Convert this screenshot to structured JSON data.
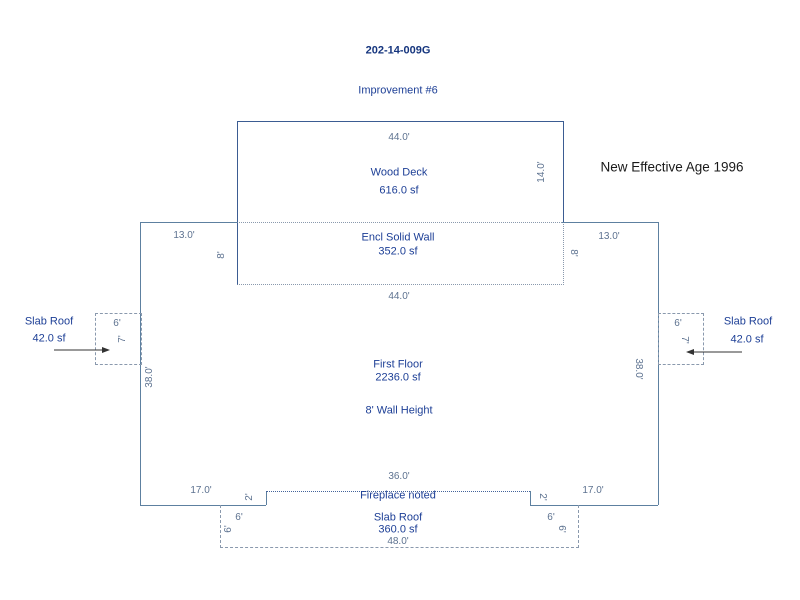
{
  "header": {
    "parcel_id": "202-14-009G",
    "improvement_label": "Improvement #6",
    "effective_age_note": "New Effective Age 1996"
  },
  "colors": {
    "label_text": "#1d3f96",
    "dimension_text": "#5d7290",
    "outline": "#5d80a0",
    "deck_outline": "#3b5c92",
    "dashed_line": "#8a99ad",
    "note_text": "#1a1a1a",
    "arrow": "#333333"
  },
  "sketch": {
    "wood_deck": {
      "label": "Wood Deck",
      "area": "616.0 sf",
      "top_dim": "44.0'",
      "right_dim": "14.0'"
    },
    "encl_solid_wall": {
      "label": "Encl Solid Wall",
      "area": "352.0 sf",
      "bottom_dim": "44.0'",
      "left_dim": "13.0'",
      "right_dim": "13.0'",
      "left_height_dim": "8'",
      "right_height_dim": "8'"
    },
    "first_floor": {
      "label": "First Floor",
      "area": "2236.0 sf",
      "wall_height_note": "8' Wall Height",
      "left_dim": "38.0'",
      "right_dim": "38.0'",
      "bottom_left_dim": "17.0'",
      "bottom_right_dim": "17.0'"
    },
    "left_slab_roof": {
      "label": "Slab Roof",
      "area": "42.0 sf",
      "width_dim": "6'",
      "depth_dim": "7'"
    },
    "right_slab_roof": {
      "label": "Slab Roof",
      "area": "42.0 sf",
      "width_dim": "6'",
      "depth_dim": "7'"
    },
    "fireplace": {
      "note": "Fireplace noted",
      "span_dim": "36.0'",
      "left_step_dim": "2'",
      "right_step_dim": "2'"
    },
    "bottom_slab_roof": {
      "label": "Slab Roof",
      "area": "360.0 sf",
      "width_dim": "48.0'",
      "left_top_dim": "6'",
      "left_side_dim": "6'",
      "right_top_dim": "6'",
      "right_side_dim": "6'"
    }
  }
}
